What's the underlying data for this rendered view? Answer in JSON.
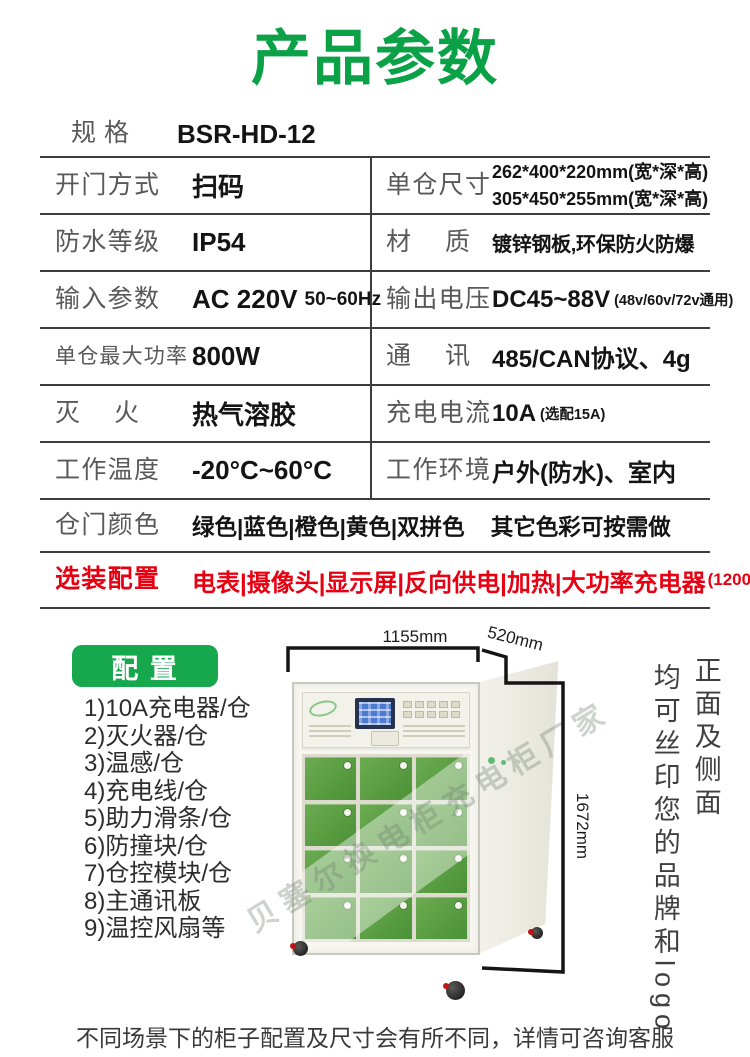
{
  "page": {
    "title": "产品参数",
    "footer_note": "不同场景下的柜子配置及尺寸会有所不同，详情可咨询客服"
  },
  "spec_table": {
    "rows": [
      {
        "type": "single",
        "label": "规格",
        "value": "BSR-HD-12"
      },
      {
        "type": "double",
        "left": {
          "label": "开门方式",
          "value": "扫码"
        },
        "right": {
          "label": "单仓尺寸",
          "value_lines": [
            "262*400*220mm(宽*深*高)",
            "305*450*255mm(宽*深*高)"
          ]
        }
      },
      {
        "type": "double",
        "left": {
          "label": "防水等级",
          "value": "IP54"
        },
        "right": {
          "label": "材质",
          "value": "镀锌钢板,环保防火防爆"
        }
      },
      {
        "type": "double",
        "left": {
          "label": "输入参数",
          "value": "AC 220V",
          "suffix": "50~60Hz"
        },
        "right": {
          "label": "输出电压",
          "value": "DC45~88V",
          "suffix": "(48v/60v/72v通用)"
        }
      },
      {
        "type": "double",
        "left": {
          "label": "单仓最大功率",
          "value": "800W"
        },
        "right": {
          "label": "通讯",
          "value": "485/CAN协议、4g"
        }
      },
      {
        "type": "double",
        "left": {
          "label": "灭火",
          "value": "热气溶胶"
        },
        "right": {
          "label": "充电电流",
          "value": "10A",
          "suffix": "(选配15A)"
        }
      },
      {
        "type": "double",
        "left": {
          "label": "工作温度",
          "value": "-20°C~60°C"
        },
        "right": {
          "label": "工作环境",
          "value": "户外(防水)、室内"
        }
      },
      {
        "type": "full",
        "label": "仓门颜色",
        "value": "绿色|蓝色|橙色|黄色|双拼色",
        "note": "其它色彩可按需做"
      },
      {
        "type": "full",
        "label": "选装配置",
        "value": "电表|摄像头|显示屏|反向供电|加热|大功率充电器",
        "suffix": "(1200W15A)",
        "highlight": true
      }
    ]
  },
  "config": {
    "badge_label": "配 置",
    "items": [
      "1)10A充电器/仓",
      "2)灭火器/仓",
      "3)温感/仓",
      "4)充电线/仓",
      "5)助力滑条/仓",
      "6)防撞块/仓",
      "7)仓控模块/仓",
      "8)主通讯板",
      "9)温控风扇等"
    ]
  },
  "product_image": {
    "dim_width": "1155mm",
    "dim_depth": "520mm",
    "dim_height": "1672mm",
    "watermark": "贝塞尔换电柜充电柜厂家",
    "side_note_1": "正面及侧面",
    "side_note_2": "均可丝印您的品牌和logo",
    "door_count": 12
  },
  "colors": {
    "title_green": "#0aa147",
    "badge_green": "#17a74c",
    "highlight_red": "#e60012",
    "line_dark": "#3d3d3d",
    "door_green_light": "#6cab52",
    "door_green_dark": "#4a9136"
  }
}
